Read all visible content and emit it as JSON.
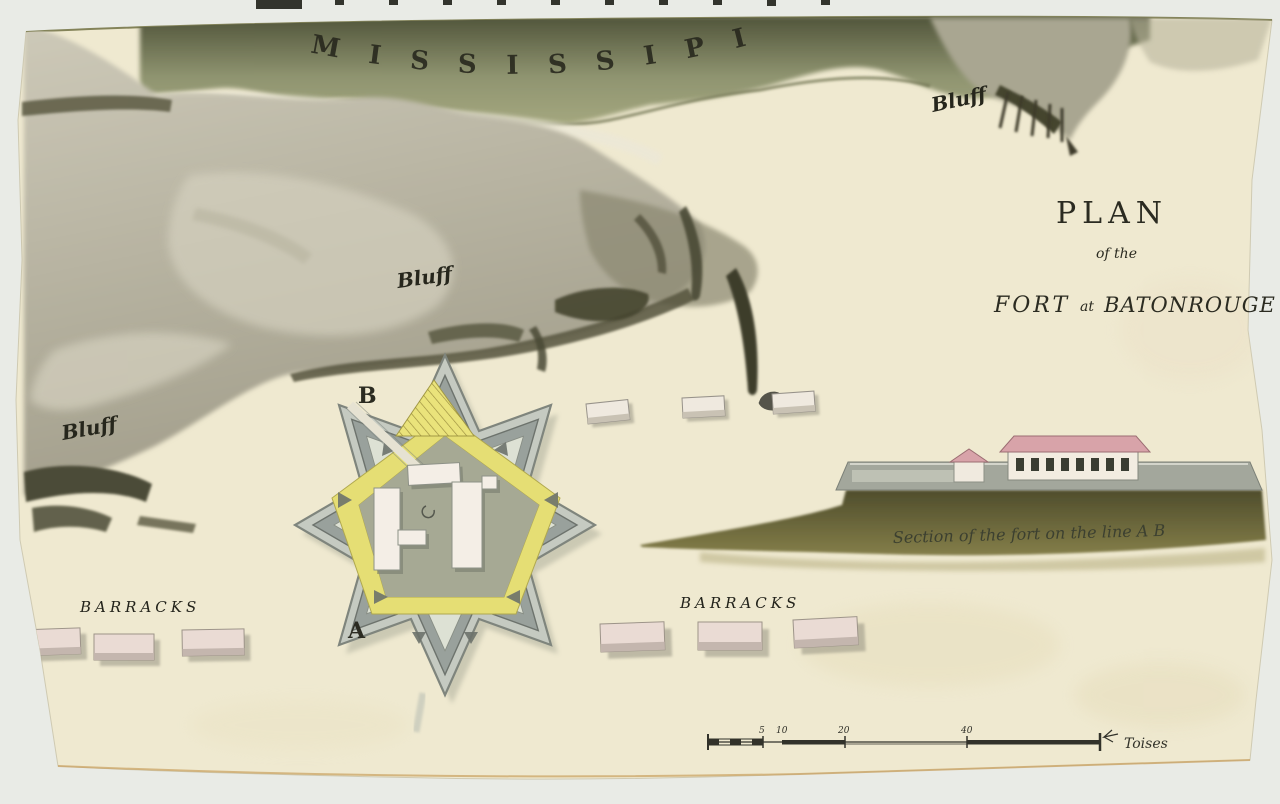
{
  "map": {
    "river": {
      "label": "MISSISSIPI"
    },
    "bluffs": {
      "labels": [
        "Bluff",
        "Bluff",
        "Bluff"
      ]
    },
    "title": {
      "main": "PLAN",
      "sub": "of the",
      "fort": "FORT",
      "connector": "at",
      "place": "BATONROUGE"
    },
    "fort": {
      "label_b": "B",
      "label_a": "A"
    },
    "barracks": {
      "left_label": "BARRACKS",
      "right_label": "BARRACKS"
    },
    "section": {
      "caption": "Section of the fort on the line A B"
    },
    "scale": {
      "tick_labels": [
        "5",
        "10",
        "20",
        "40"
      ],
      "unit": "Toises"
    },
    "palette": {
      "background": "#e9ebe6",
      "paper": "#efe9d0",
      "river_green": "#8f9470",
      "bluff_gray": "#aaa693",
      "bluff_dark": "#4a4936",
      "fort_yellow": "#e5de74",
      "rampart_gray": "#99a19c",
      "building_white": "#f2ece1",
      "building_pink": "#eadbd4",
      "roof_pink": "#d8a3a9",
      "ground_olive": "#6b683c",
      "ink": "#2b2b21"
    }
  }
}
